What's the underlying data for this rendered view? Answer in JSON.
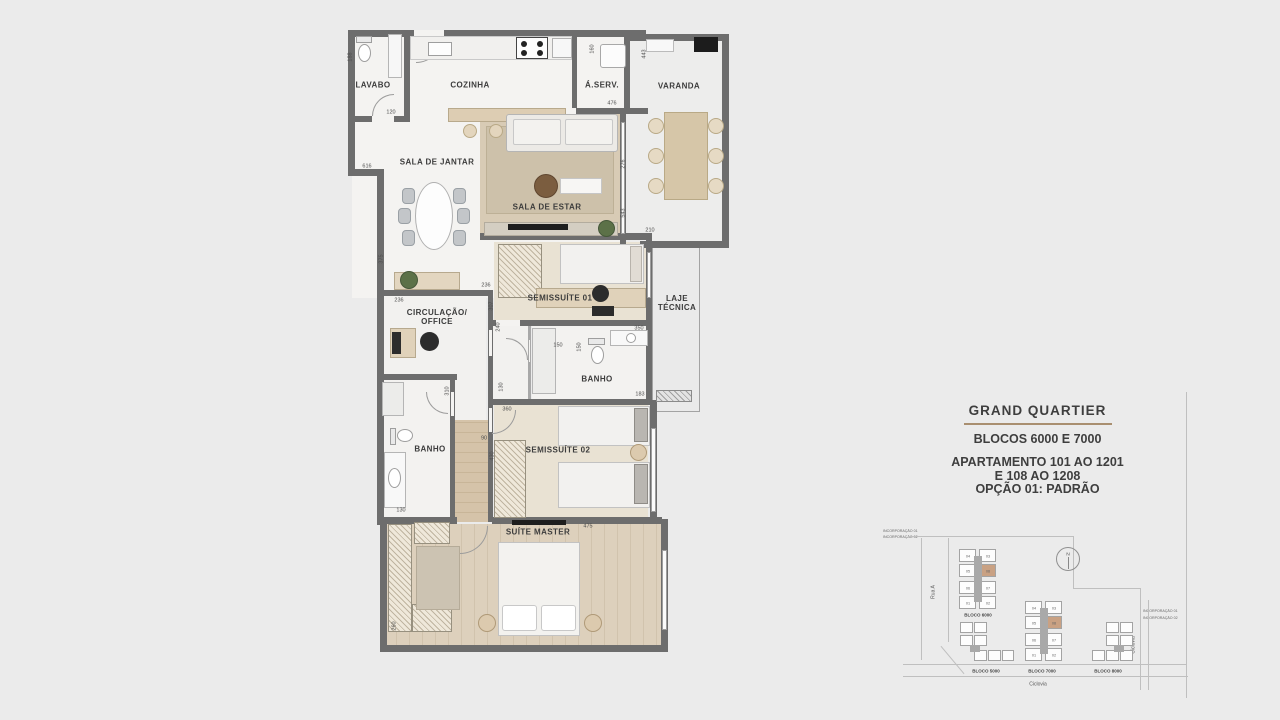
{
  "rooms": {
    "lavabo": "LAVABO",
    "cozinha": "COZINHA",
    "aserv": "Á.SERV.",
    "varanda": "VARANDA",
    "sala_jantar": "SALA DE JANTAR",
    "sala_estar": "SALA DE ESTAR",
    "semissuite1": "SEMISSUÍTE 01",
    "laje": "LAJE\nTÉCNICA",
    "circulacao": "CIRCULAÇÃO/\nOFFICE",
    "banho1": "BANHO",
    "banho2": "BANHO",
    "semissuite2": "SEMISSUÍTE 02",
    "suite_master": "SUÍTE MASTER"
  },
  "dims": {
    "lavabo_depth": "188",
    "lavabo_width": "120",
    "aserv_side": "160",
    "varanda_top": "443",
    "cozinha_width": "476",
    "jantar_width": "616",
    "estar_a": "276",
    "estar_b": "543",
    "varanda_bottom": "210",
    "jantar_depth": "375",
    "circ_a": "236",
    "circ_b": "236",
    "circ_depth": "307",
    "ss1_depth": "240",
    "ss1_width": "350",
    "banho1_a": "150",
    "banho1_b": "150",
    "banho1_c": "130",
    "laje_bottom": "183",
    "banho2_depth": "310",
    "banho2_width": "130",
    "hall": "90",
    "ss2_depth": "430",
    "ss2_a": "360",
    "ss2_width": "475",
    "master_depth": "260"
  },
  "title_block": {
    "title": "GRAND QUARTIER",
    "subtitle": "BLOCOS 6000 E 7000",
    "line2": "APARTAMENTO 101 AO 1201",
    "line3": "E 108 AO 1208",
    "line4": "OPÇÃO 01: PADRÃO"
  },
  "site_plan": {
    "incorporacao_left": [
      "INCORPORAÇÃO 01",
      "INCORPORAÇÃO 02"
    ],
    "incorporacao_right": [
      "INCORPORAÇÃO 01",
      "INCORPORAÇÃO 02"
    ],
    "rua_label": "Rua A",
    "ciclovia_bottom": "Ciclovia",
    "ciclovia_right": "Ciclovia",
    "north_label": "N",
    "blocos": [
      {
        "label": "BLOCO 6000",
        "units": [
          "04",
          "03",
          "05",
          "08",
          "06",
          "07",
          "01",
          "02"
        ]
      },
      {
        "label": "BLOCO 5000"
      },
      {
        "label": "BLOCO 7000",
        "units": [
          "04",
          "03",
          "05",
          "08",
          "06",
          "07",
          "01",
          "02"
        ]
      },
      {
        "label": "BLOCO 8000"
      }
    ]
  },
  "colors": {
    "background": "#ebebeb",
    "wall": "#6d6d6d",
    "wood_floor": "#d9cdba",
    "highlight_unit": "#c9a183",
    "title_rule": "#a98f70"
  }
}
